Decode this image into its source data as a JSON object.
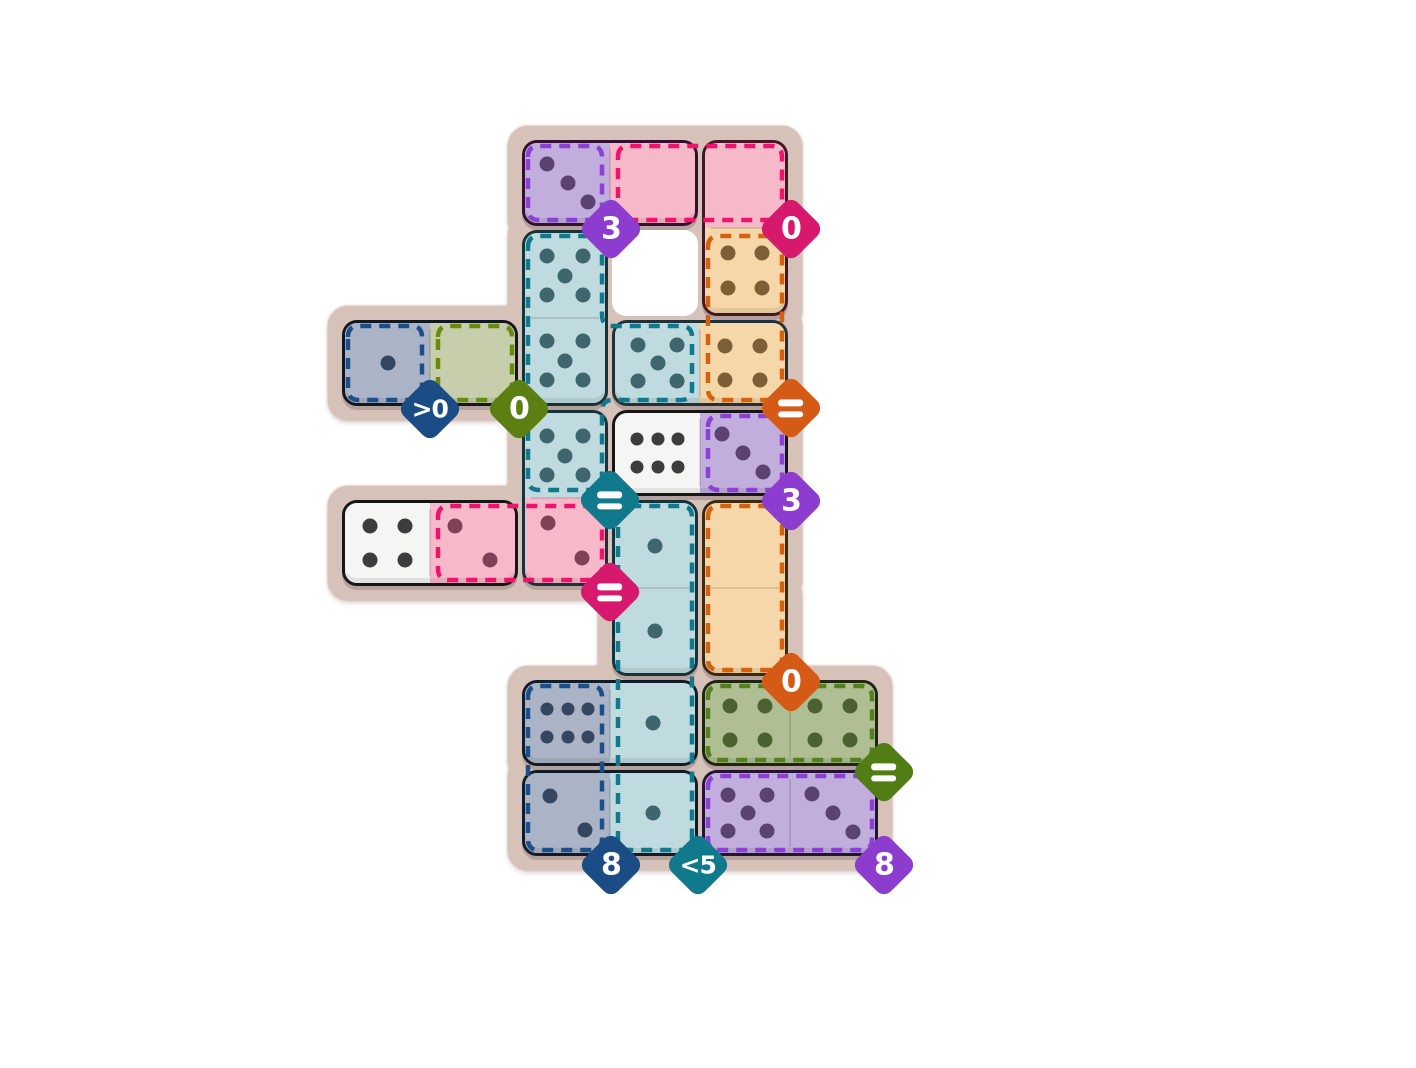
{
  "board": {
    "page_bg": "#ffffff",
    "surface_color": "#D7C2BA",
    "surface_edge_color": "#BFA096",
    "hole_color": "#ffffff",
    "grid": {
      "origin_x": 340,
      "origin_y": 138,
      "cell_px": 90,
      "cols": 6,
      "rows": 8
    },
    "holes": [
      [
        3,
        1
      ]
    ],
    "palette": {
      "purple": {
        "fill": "#C2AEDC",
        "pip": "#5A4272",
        "dash": "#8C40D6",
        "badge": "#8C3CCE"
      },
      "pink": {
        "fill": "#F6B9CA",
        "pip": "#7E4156",
        "dash": "#F0136B",
        "badge": "#D6196D"
      },
      "tan": {
        "fill": "#F6D7A9",
        "pip": "#7D5F36",
        "dash": "#D5610D",
        "badge": "#D55A15"
      },
      "teal": {
        "fill": "#BFDBDF",
        "pip": "#3F656D",
        "dash": "#10798C",
        "badge": "#11798C"
      },
      "navy": {
        "fill": "#ABB4C6",
        "pip": "#35465E",
        "dash": "#1C4F8A",
        "badge": "#1C4C86"
      },
      "olive": {
        "fill": "#C6CEAC",
        "pip": "#5E701F",
        "dash": "#6A8A0C",
        "badge": "#5B7F10"
      },
      "green": {
        "fill": "#AFBF93",
        "pip": "#4C6130",
        "dash": "#55801E",
        "badge": "#527C14"
      },
      "white": {
        "fill": "#F5F5F4",
        "pip": "#3C3C3C",
        "dash": "none",
        "badge": "none"
      }
    },
    "zones": [
      {
        "name": "purple-sum-3",
        "color": "purple",
        "cells": [
          [
            2,
            0
          ]
        ],
        "badge": {
          "label": "3",
          "x": 611,
          "y": 229
        }
      },
      {
        "name": "pink-sum-0",
        "color": "pink",
        "cells": [
          [
            3,
            0
          ],
          [
            4,
            0
          ]
        ],
        "badge": {
          "label": "0",
          "x": 791,
          "y": 229
        }
      },
      {
        "name": "tan-all-equal",
        "color": "tan",
        "cells": [
          [
            4,
            1
          ],
          [
            4,
            2
          ]
        ],
        "badge": {
          "label": "=",
          "x": 791,
          "y": 408
        }
      },
      {
        "name": "navy-greater-0",
        "color": "navy",
        "cells": [
          [
            0,
            2
          ]
        ],
        "badge": {
          "label": ">0",
          "x": 430,
          "y": 409
        }
      },
      {
        "name": "olive-sum-0",
        "color": "olive",
        "cells": [
          [
            1,
            2
          ]
        ],
        "badge": {
          "label": "0",
          "x": 519,
          "y": 409
        }
      },
      {
        "name": "teal-all-equal",
        "color": "teal",
        "cells": [
          [
            2,
            1
          ],
          [
            2,
            2
          ],
          [
            2,
            3
          ],
          [
            3,
            2
          ]
        ],
        "badge": {
          "label": "=",
          "x": 610,
          "y": 500
        }
      },
      {
        "name": "purple-sum-3b",
        "color": "purple",
        "cells": [
          [
            4,
            3
          ]
        ],
        "badge": {
          "label": "3",
          "x": 791,
          "y": 501
        }
      },
      {
        "name": "pink-all-equal",
        "color": "pink",
        "cells": [
          [
            1,
            4
          ],
          [
            2,
            4
          ]
        ],
        "badge": {
          "label": "=",
          "x": 610,
          "y": 592
        }
      },
      {
        "name": "tan-sum-0",
        "color": "tan",
        "cells": [
          [
            4,
            4
          ],
          [
            4,
            5
          ]
        ],
        "badge": {
          "label": "0",
          "x": 791,
          "y": 682
        }
      },
      {
        "name": "green-all-equal",
        "color": "green",
        "cells": [
          [
            4,
            6
          ],
          [
            5,
            6
          ]
        ],
        "badge": {
          "label": "=",
          "x": 884,
          "y": 772
        }
      },
      {
        "name": "navy-sum-8",
        "color": "navy",
        "cells": [
          [
            2,
            6
          ],
          [
            2,
            7
          ]
        ],
        "badge": {
          "label": "8",
          "x": 611,
          "y": 865
        }
      },
      {
        "name": "teal-less-5",
        "color": "teal",
        "cells": [
          [
            3,
            4
          ],
          [
            3,
            5
          ],
          [
            3,
            6
          ],
          [
            3,
            7
          ]
        ],
        "badge": {
          "label": "<5",
          "x": 698,
          "y": 865
        }
      },
      {
        "name": "purple-sum-8",
        "color": "purple",
        "cells": [
          [
            4,
            7
          ],
          [
            5,
            7
          ]
        ],
        "badge": {
          "label": "8",
          "x": 884,
          "y": 865
        }
      }
    ],
    "dominoes": [
      {
        "cells": [
          [
            2,
            0
          ],
          [
            3,
            0
          ]
        ],
        "pips": [
          3,
          0
        ],
        "colors": [
          "purple",
          "pink"
        ],
        "outline": "#33102F"
      },
      {
        "cells": [
          [
            4,
            0
          ],
          [
            4,
            1
          ]
        ],
        "pips": [
          0,
          4
        ],
        "colors": [
          "pink",
          "tan"
        ],
        "outline": "#441726"
      },
      {
        "cells": [
          [
            2,
            1
          ],
          [
            2,
            2
          ]
        ],
        "pips": [
          5,
          5
        ],
        "colors": [
          "teal",
          "teal"
        ],
        "outline": "#14333B"
      },
      {
        "cells": [
          [
            0,
            2
          ],
          [
            1,
            2
          ]
        ],
        "pips": [
          1,
          0
        ],
        "colors": [
          "navy",
          "olive"
        ],
        "outline": "#101820"
      },
      {
        "cells": [
          [
            3,
            2
          ],
          [
            4,
            2
          ]
        ],
        "pips": [
          5,
          4
        ],
        "colors": [
          "teal",
          "tan"
        ],
        "outline": "#21313A"
      },
      {
        "cells": [
          [
            3,
            3
          ],
          [
            4,
            3
          ]
        ],
        "pips": [
          6,
          3
        ],
        "colors": [
          "white",
          "purple"
        ],
        "outline": "#161616"
      },
      {
        "cells": [
          [
            2,
            3
          ],
          [
            2,
            4
          ]
        ],
        "pips": [
          5,
          2
        ],
        "colors": [
          "teal",
          "pink"
        ],
        "outline": "#19333B"
      },
      {
        "cells": [
          [
            0,
            4
          ],
          [
            1,
            4
          ]
        ],
        "pips": [
          4,
          2
        ],
        "colors": [
          "white",
          "pink"
        ],
        "outline": "#161616"
      },
      {
        "cells": [
          [
            4,
            4
          ],
          [
            4,
            5
          ]
        ],
        "pips": [
          0,
          0
        ],
        "colors": [
          "tan",
          "tan"
        ],
        "outline": "#3D2B10"
      },
      {
        "cells": [
          [
            3,
            4
          ],
          [
            3,
            5
          ]
        ],
        "pips": [
          1,
          1
        ],
        "colors": [
          "teal",
          "teal"
        ],
        "outline": "#14333B"
      },
      {
        "cells": [
          [
            2,
            6
          ],
          [
            3,
            6
          ]
        ],
        "pips": [
          6,
          1
        ],
        "colors": [
          "navy",
          "teal"
        ],
        "outline": "#0F1D2B"
      },
      {
        "cells": [
          [
            2,
            7
          ],
          [
            3,
            7
          ]
        ],
        "pips": [
          2,
          1
        ],
        "colors": [
          "navy",
          "teal"
        ],
        "outline": "#0F1D2B"
      },
      {
        "cells": [
          [
            4,
            6
          ],
          [
            5,
            6
          ]
        ],
        "pips": [
          4,
          4
        ],
        "colors": [
          "green",
          "green"
        ],
        "outline": "#1C2611"
      },
      {
        "cells": [
          [
            4,
            7
          ],
          [
            5,
            7
          ]
        ],
        "pips": [
          5,
          3
        ],
        "colors": [
          "purple",
          "purple"
        ],
        "outline": "#241433"
      }
    ],
    "pip_layouts": {
      "0": [],
      "1": [
        [
          50,
          50
        ]
      ],
      "2": [
        [
          29,
          29
        ],
        [
          71,
          71
        ]
      ],
      "3": [
        [
          26,
          26
        ],
        [
          50,
          50
        ],
        [
          74,
          74
        ]
      ],
      "4": [
        [
          29,
          29
        ],
        [
          71,
          29
        ],
        [
          29,
          71
        ],
        [
          71,
          71
        ]
      ],
      "5": [
        [
          27,
          27
        ],
        [
          73,
          27
        ],
        [
          50,
          50
        ],
        [
          27,
          73
        ],
        [
          73,
          73
        ]
      ],
      "6": [
        [
          26,
          33
        ],
        [
          50,
          33
        ],
        [
          74,
          33
        ],
        [
          26,
          67
        ],
        [
          50,
          67
        ],
        [
          74,
          67
        ]
      ]
    }
  }
}
